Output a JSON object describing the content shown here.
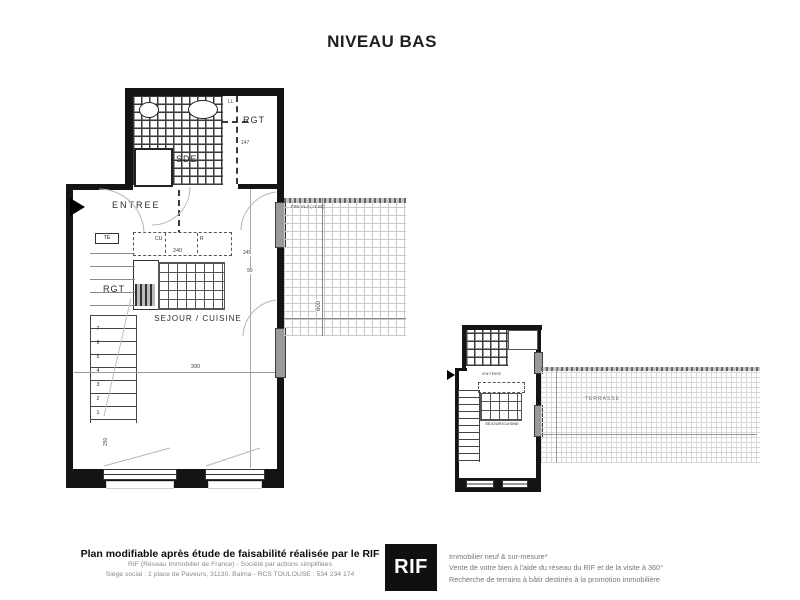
{
  "title": "NIVEAU BAS",
  "main_plan": {
    "rooms": {
      "entree": "ENTREE",
      "sde": "SDE",
      "rgt_top": "RGT",
      "rgt_stairs": "RGT",
      "sejour": "SEJOUR / CUISINE"
    },
    "labels": {
      "ll": "LL",
      "te": "TE",
      "cu": "CU",
      "r": "R"
    },
    "dims": {
      "d240": "240",
      "d245": "245",
      "d90": "90",
      "d147": "147",
      "d390": "390",
      "d600": "600",
      "d250": "250"
    },
    "terrace_note": "FINI VLA (+1.80)",
    "stairs": [
      "1",
      "2",
      "3",
      "4",
      "5",
      "6",
      "7"
    ]
  },
  "small_plan": {
    "entree": "ENTREE",
    "sejour": "SEJOUR/CUISINE",
    "terrasse": "TERRASSE"
  },
  "footer": {
    "left_bold": "Plan modifiable après étude de faisabilité réalisée par le RIF",
    "left_line2": "RIF (Réseau Immobilier de France) - Société par actions simplifiées",
    "left_line3": "Siège social : 1 place de Paveurs, 31130, Balma - RCS TOULOUSE : 534 234 174",
    "logo": "RIF",
    "right_line1": "Immobilier neuf & sur-mesure*",
    "right_line2": "Vente de votre bien à l'aide du réseau du RIF et de la visite à 360°",
    "right_line3": "Recherche de terrains à bâtir destinés à la promotion immobilière"
  }
}
